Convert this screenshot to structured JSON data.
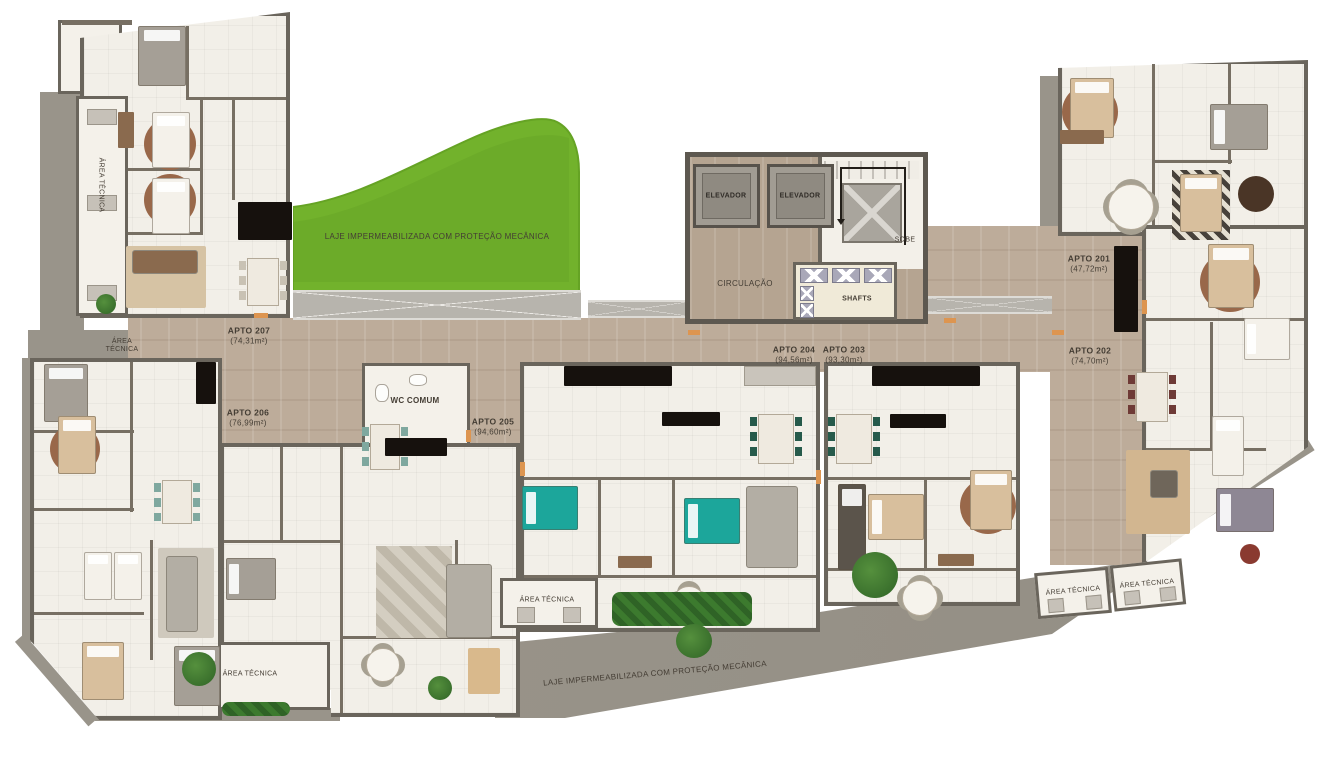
{
  "plan": {
    "core": {
      "elevator": "ELEVADOR",
      "sobe": "SOBE",
      "circulacao": "CIRCULAÇÃO",
      "shafts": "SHAFTS"
    },
    "rooms": {
      "wc_comum": "WC COMUM",
      "area_tecnica": "ÁREA TÉCNICA"
    },
    "slabs": {
      "laje": "LAJE IMPERMEABILIZADA COM PROTEÇÃO MECÂNICA"
    },
    "apartments": [
      {
        "name": "APTO 201",
        "area": "(47,72m²)"
      },
      {
        "name": "APTO 202",
        "area": "(74,70m²)"
      },
      {
        "name": "APTO 203",
        "area": "(93,30m²)"
      },
      {
        "name": "APTO 204",
        "area": "(94,56m²)"
      },
      {
        "name": "APTO 205",
        "area": "(94,60m²)"
      },
      {
        "name": "APTO 206",
        "area": "(76,99m²)"
      },
      {
        "name": "APTO 207",
        "area": "(74,31m²)"
      }
    ],
    "colors": {
      "grass": "#72b22c",
      "wood": "#bdac9a",
      "slab": "#99948a",
      "wall": "#6a655c",
      "floor": "#f2efe8",
      "accent_teal": "#1ca69b",
      "accent_orange": "#dd9550"
    }
  }
}
